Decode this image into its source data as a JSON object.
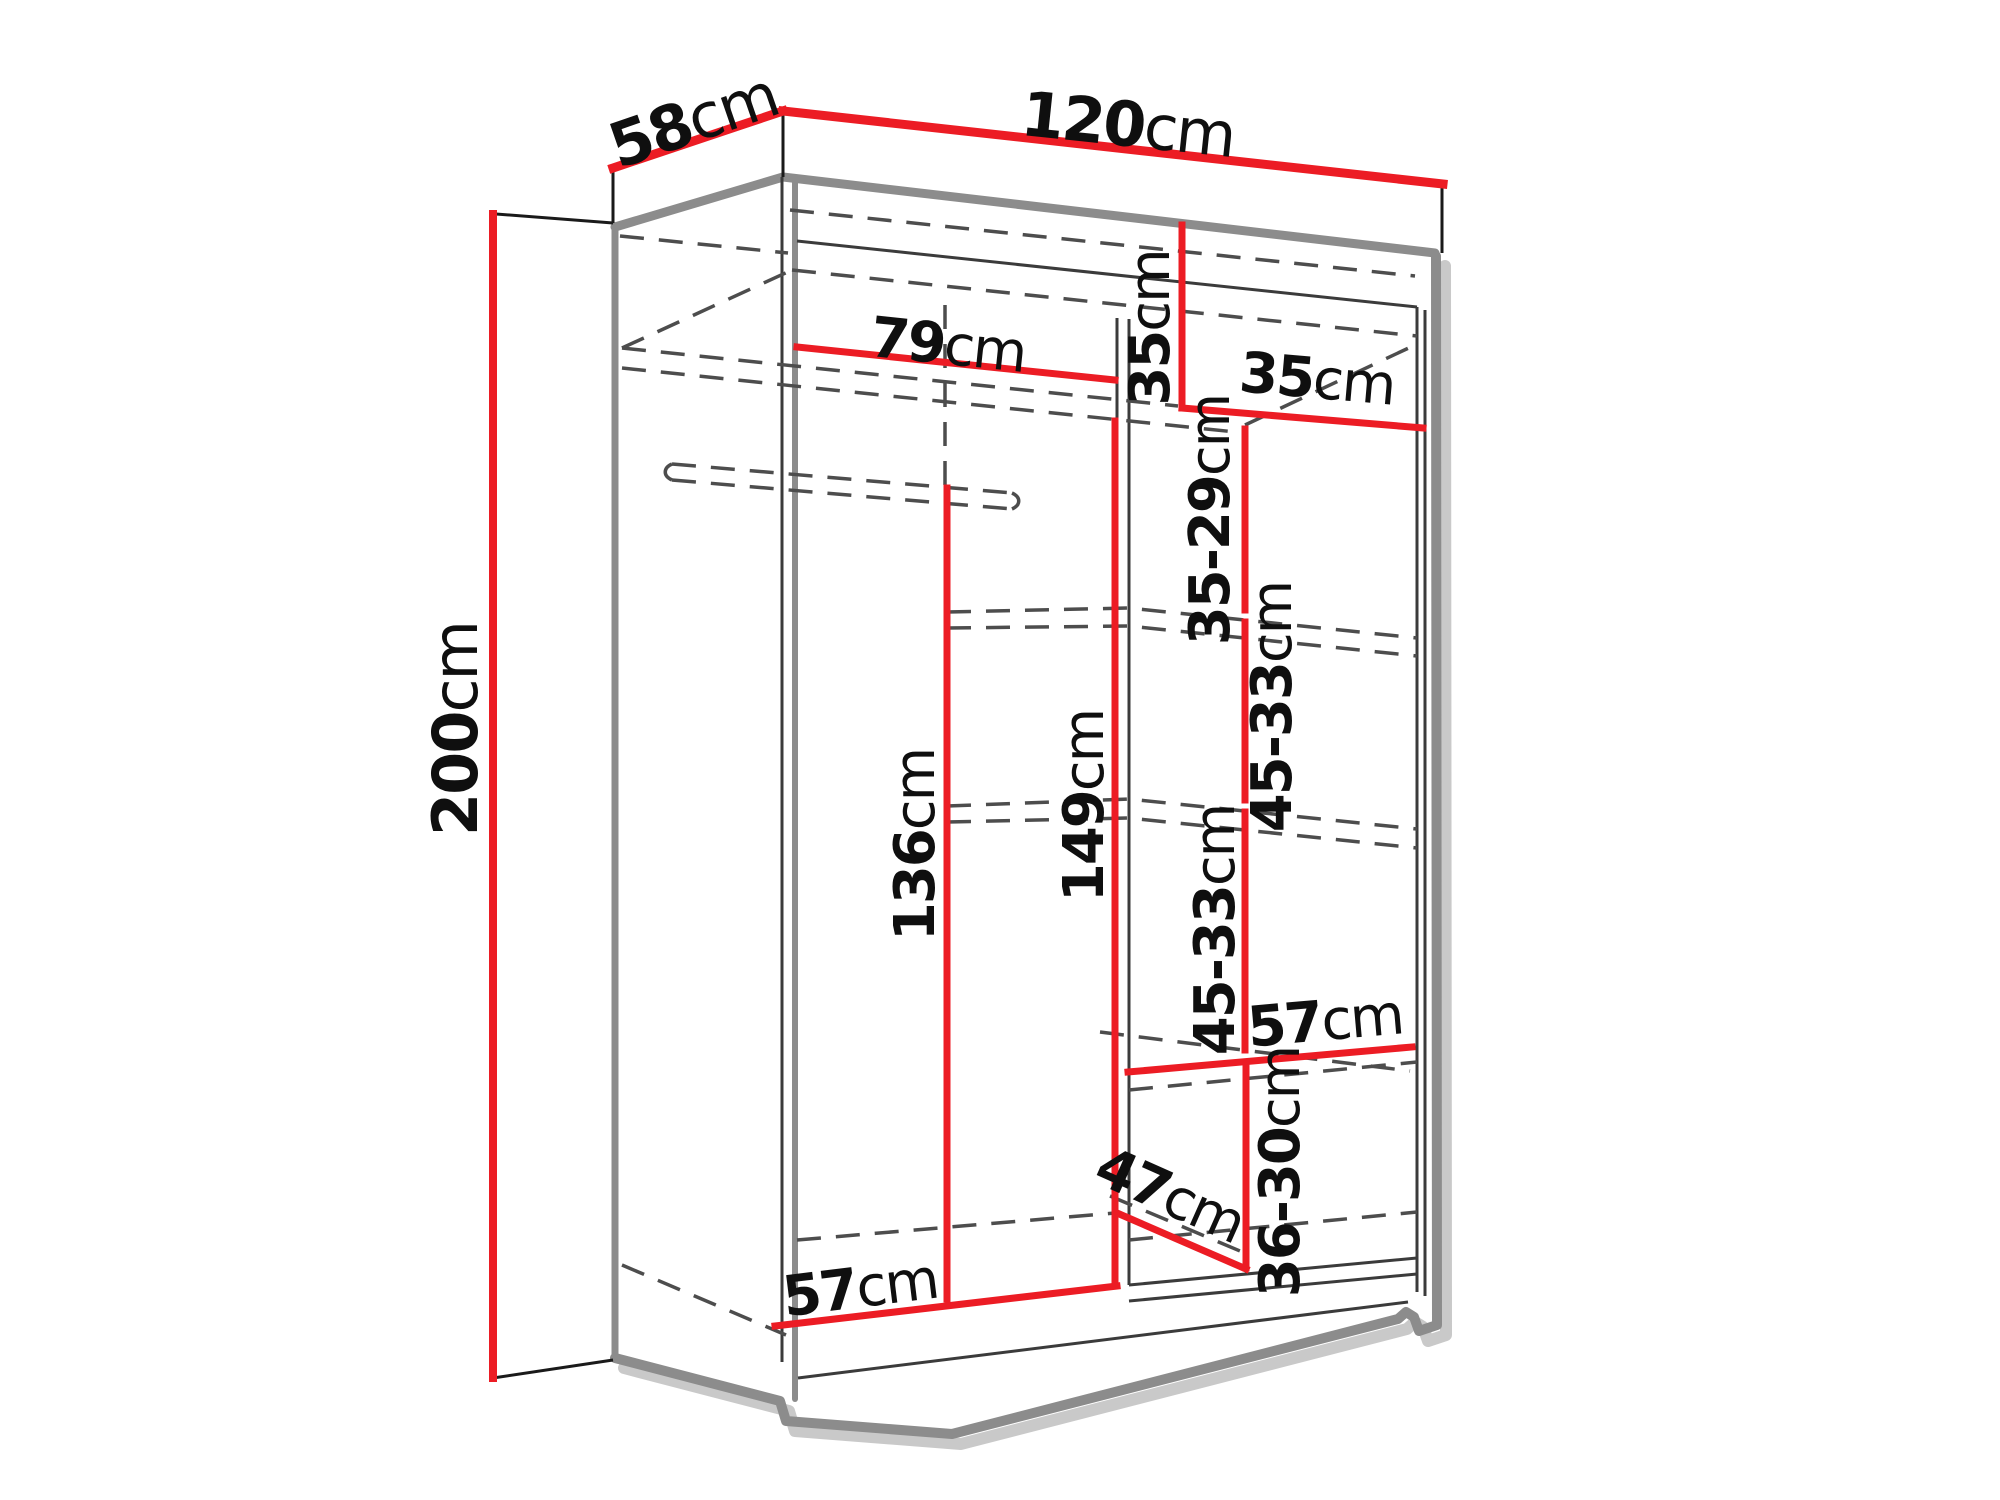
{
  "page": {
    "background": "#ffffff"
  },
  "diagram": {
    "type": "furniture-dimension-diagram",
    "subject": "wardrobe interior dimensions",
    "unit": "cm",
    "colors": {
      "dimension_line": "#EC1C24",
      "outline": "#8C8C8C",
      "hidden_line": "#4D4D4D",
      "label_text": "#0F0F0F"
    },
    "labels": {
      "depth_top": {
        "value": "58",
        "unit": "cm"
      },
      "width_top": {
        "value": "120",
        "unit": "cm"
      },
      "height_left": {
        "value": "200",
        "unit": "cm"
      },
      "hanging_width": {
        "value": "79",
        "unit": "cm"
      },
      "upper_right_heightطneverused": null,
      "upper_right_height": {
        "value": "35",
        "unit": "cm"
      },
      "upper_right_width": {
        "value": "35",
        "unit": "cm"
      },
      "shelf_gap_1": {
        "value": "35-29",
        "unit": "cm"
      },
      "shelf_gap_2": {
        "value": "45-33",
        "unit": "cm"
      },
      "shelf_gap_3": {
        "value": "45-33",
        "unit": "cm"
      },
      "shelf_width": {
        "value": "57",
        "unit": "cm"
      },
      "shelf_gap_4": {
        "value": "36-30",
        "unit": "cm"
      },
      "bottom_depth": {
        "value": "47",
        "unit": "cm"
      },
      "hanging_height": {
        "value": "136",
        "unit": "cm"
      },
      "middle_height": {
        "value": "149",
        "unit": "cm"
      },
      "bottom_width": {
        "value": "57",
        "unit": "cm"
      }
    }
  }
}
